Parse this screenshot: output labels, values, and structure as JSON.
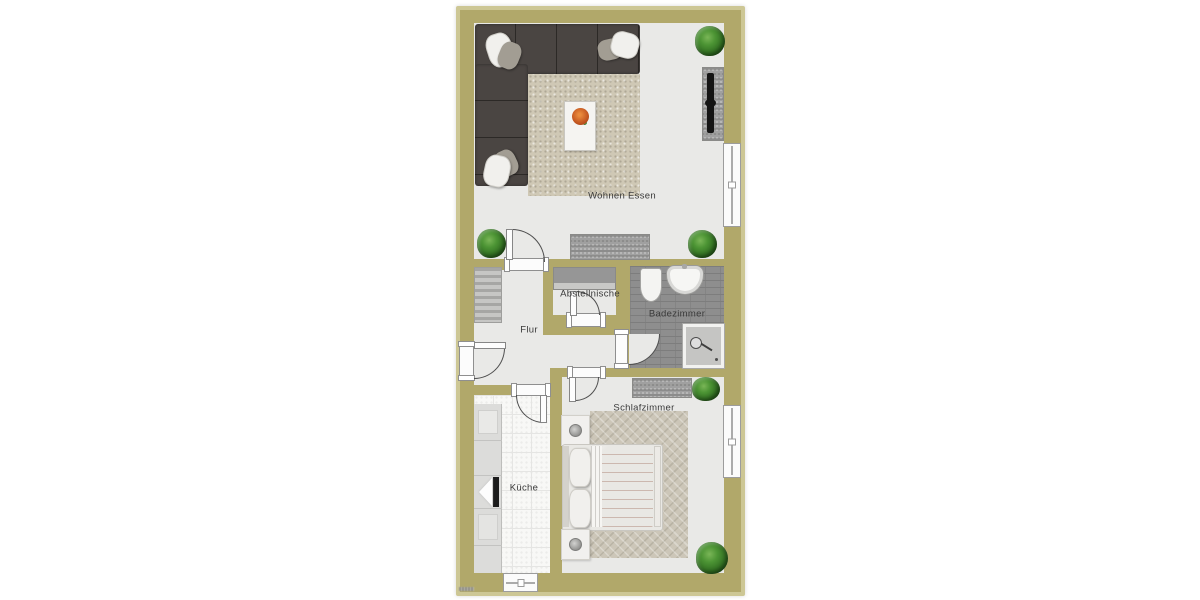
{
  "plan": {
    "rooms": [
      {
        "id": "wohnen-essen",
        "label": "Wohnen Essen"
      },
      {
        "id": "flur",
        "label": "Flur"
      },
      {
        "id": "abstellnische",
        "label": "Abstellnische"
      },
      {
        "id": "badezimmer",
        "label": "Badezimmer"
      },
      {
        "id": "schlafzimmer",
        "label": "Schlafzimmer"
      },
      {
        "id": "kueche",
        "label": "Küche"
      }
    ]
  },
  "colors": {
    "wall": "#b1a86a",
    "wall-edge": "#cdc795",
    "floor": "#e9e9e7",
    "bath-tile": "#8e8e8e",
    "sofa": "#4a4542",
    "living-rug": "#cfc8b5",
    "bedroom-carpet": "#ccc6b8",
    "duvet": "#b5522f",
    "plant": "#4c9434",
    "furniture-gray": "#a0a0a0",
    "counter": "#dcdcda",
    "door-line": "#4f4f4f",
    "label": "#3a3a3a"
  }
}
